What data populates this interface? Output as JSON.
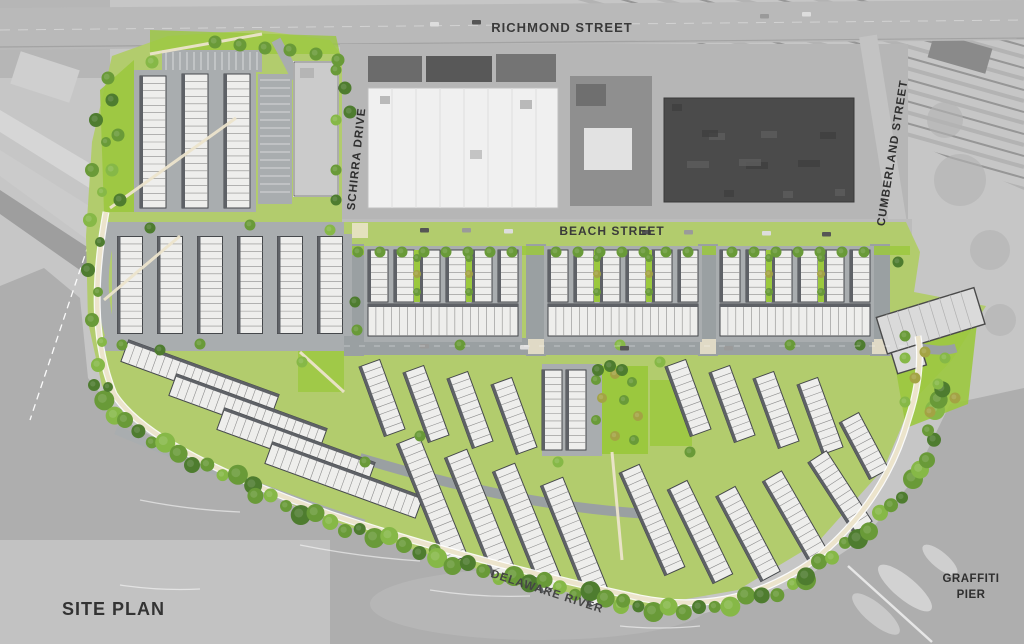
{
  "title": "SITE PLAN",
  "labels": {
    "richmond_street": "RICHMOND STREET",
    "beach_street": "BEACH STREET",
    "schirra_drive": "SCHIRRA DRIVE",
    "cumberland_street": "CUMBERLAND STREET",
    "delaware_river": "DELAWARE RIVER",
    "graffiti_pier_line1": "GRAFFITI",
    "graffiti_pier_line2": "PIER"
  },
  "colors": {
    "aerial_base": "#c6c6c6",
    "aerial_road": "#b9b9b9",
    "aerial_light": "#d6d6d6",
    "aerial_dark": "#9e9e9e",
    "water": "#aeaeae",
    "water_light": "#c7c7c7",
    "site_green": "#b2cc6d",
    "lawn_bright": "#9bc83e",
    "tree_dark": "#4e7c2f",
    "tree_mid": "#699a38",
    "tree_light": "#86b847",
    "tree_olive": "#a3a344",
    "road": "#9aa0a2",
    "aisle": "#a9adaf",
    "townhouse_fill": "#eeeeec",
    "townhouse_stroke": "#45484b",
    "townhouse_div": "#8d8d8d",
    "townhouse_shadow": "#5e6166",
    "building_gray": "#cbcbcb",
    "warehouse_white": "#f0f0f0",
    "industrial_dark": "#4b4b4b",
    "industrial_mid": "#8f8f8f",
    "path_cream": "#ece4cc",
    "white": "#ffffff",
    "label_text": "#3a3a3a"
  }
}
